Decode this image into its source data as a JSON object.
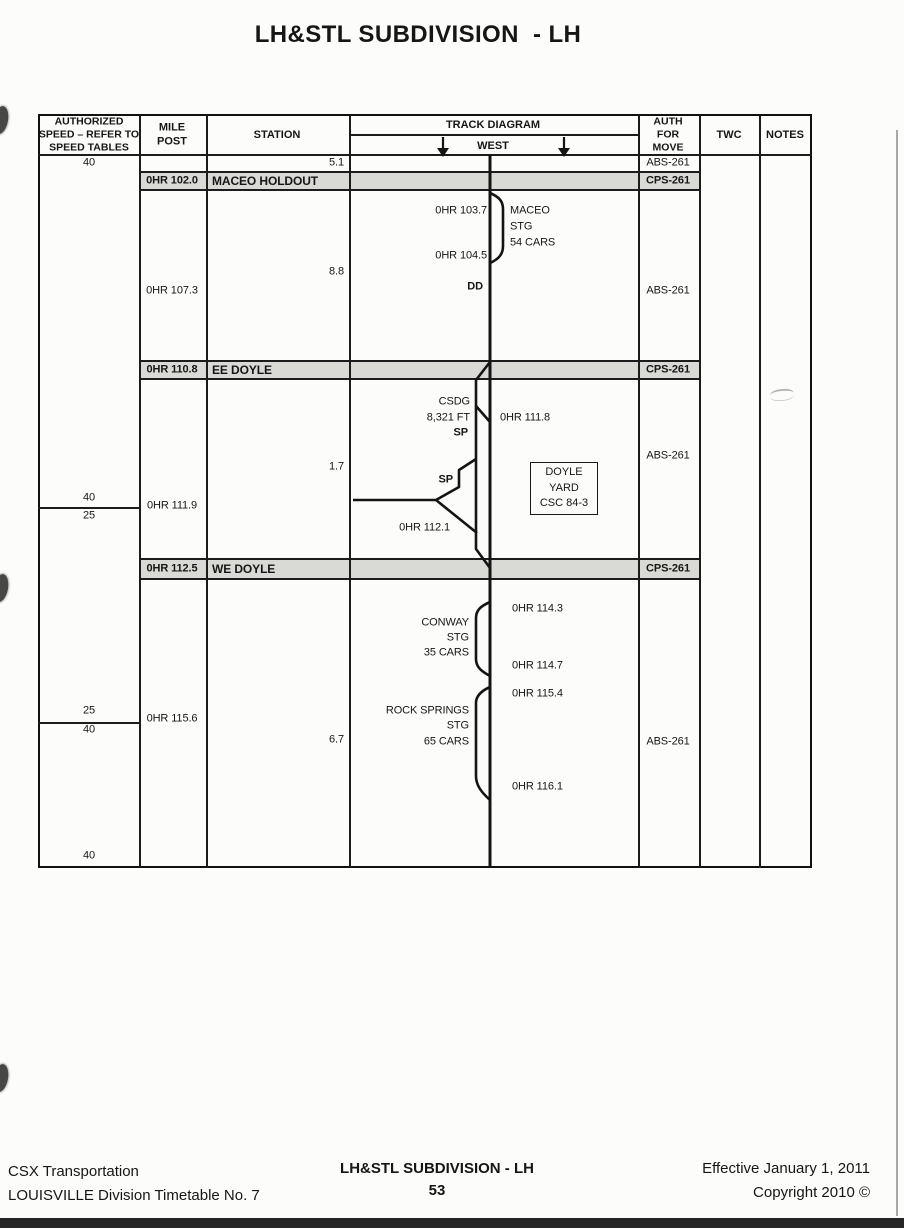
{
  "title": "LH&STL SUBDIVISION  - LH",
  "table_header": {
    "speed": "AUTHORIZED\nSPEED – REFER TO\nSPEED TABLES",
    "mile_post": "MILE\nPOST",
    "station": "STATION",
    "track_diagram": "TRACK DIAGRAM",
    "direction": "WEST",
    "auth_for_move": "AUTH\nFOR\nMOVE",
    "twc": "TWC",
    "notes": "NOTES"
  },
  "speed_column": {
    "top": "40",
    "div1_above": "40",
    "div1_below": "25",
    "div2_above": "25",
    "div2_below": "40",
    "bottom": "40"
  },
  "first_row": {
    "distance": "5.1",
    "auth": "ABS-261"
  },
  "stations": {
    "maceo_holdout": {
      "mile": "0HR 102.0",
      "name": "MACEO HOLDOUT",
      "auth": "CPS-261"
    },
    "ee_doyle": {
      "mile": "0HR 110.8",
      "name": "EE DOYLE",
      "auth": "CPS-261"
    },
    "we_doyle": {
      "mile": "0HR 112.5",
      "name": "WE DOYLE",
      "auth": "CPS-261"
    }
  },
  "sections": {
    "maceo": {
      "mile_post": "0HR 107.3",
      "distance": "8.8",
      "auth": "ABS-261",
      "siding_top_mp": "0HR 103.7",
      "siding_bottom_mp": "0HR 104.5",
      "siding_name": "MACEO",
      "siding_type": "STG",
      "siding_capacity": "54 CARS",
      "defect_detector": "DD"
    },
    "doyle": {
      "mile_post": "0HR 111.9",
      "distance": "1.7",
      "auth": "ABS-261",
      "siding_name": "CSDG",
      "siding_length": "8,321 FT",
      "sp_upper": "SP",
      "sp_lower": "SP",
      "crossover_mp": "0HR 111.8",
      "yard_lead_mp": "0HR 112.1",
      "yard_box": {
        "line1": "DOYLE",
        "line2": "YARD",
        "line3": "CSC 84-3"
      }
    },
    "conway_rock_springs": {
      "mile_post": "0HR 115.6",
      "distance": "6.7",
      "auth": "ABS-261",
      "conway_top_mp": "0HR 114.3",
      "conway_name": "CONWAY",
      "conway_type": "STG",
      "conway_capacity": "35 CARS",
      "conway_bottom_mp": "0HR 114.7",
      "rs_top_mp": "0HR 115.4",
      "rs_name": "ROCK SPRINGS",
      "rs_type": "STG",
      "rs_capacity": "65 CARS",
      "rs_bottom_mp": "0HR 116.1"
    }
  },
  "footer": {
    "company": "CSX Transportation",
    "timetable": "LOUISVILLE Division Timetable No. 7",
    "subdivision": "LH&STL SUBDIVISION - LH",
    "page_number": "53",
    "effective": "Effective January 1, 2011",
    "copyright": "Copyright 2010 ©"
  }
}
